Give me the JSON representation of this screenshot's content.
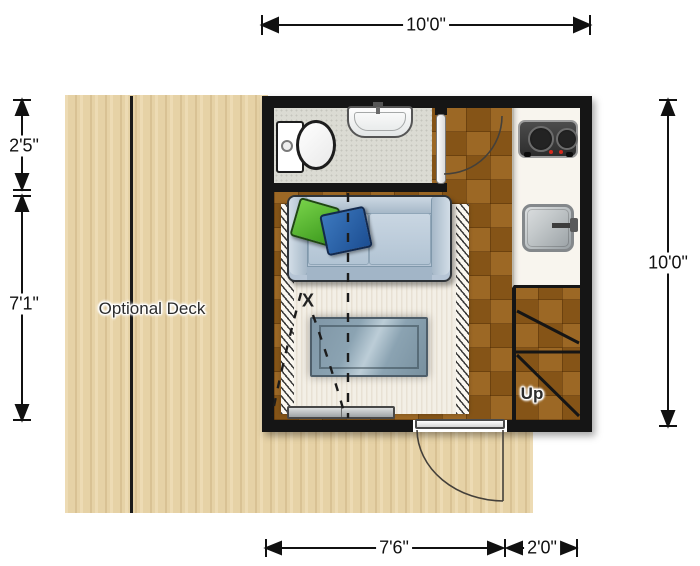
{
  "plan": {
    "dimensions": {
      "top_width": "10'0\"",
      "right_height": "10'0\"",
      "left_bathroom_depth": "2'5\"",
      "left_living_depth": "7'1\"",
      "bottom_living_width": "7'6\"",
      "bottom_entry_width": "2'0\""
    },
    "labels": {
      "deck": "Optional Deck",
      "stairs": "Up",
      "floor_mark": "X"
    },
    "fixtures": [
      "optional-deck",
      "toilet",
      "bathroom-sink",
      "bathroom-door",
      "two-burner-stove",
      "kitchen-sink",
      "kitchen-counter",
      "sofa",
      "green-throw-pillow",
      "blue-throw-pillow",
      "area-rug",
      "coffee-table",
      "media-console",
      "winder-stairs",
      "entry-door",
      "murphy-bed-fold-guides"
    ],
    "colors": {
      "wall": "#151515",
      "deck_wood": "#e8d5ab",
      "interior_wood": "#8f5c1d",
      "bathroom_floor": "#dbdbd3",
      "counter": "#f8f5ee",
      "sofa": "#b6c5d5",
      "pillow_green": "#58b52f",
      "pillow_blue": "#275fa6",
      "rug": "#f3efe6",
      "table_glass": "#8ba3b2",
      "dimension_ink": "#111111"
    }
  }
}
